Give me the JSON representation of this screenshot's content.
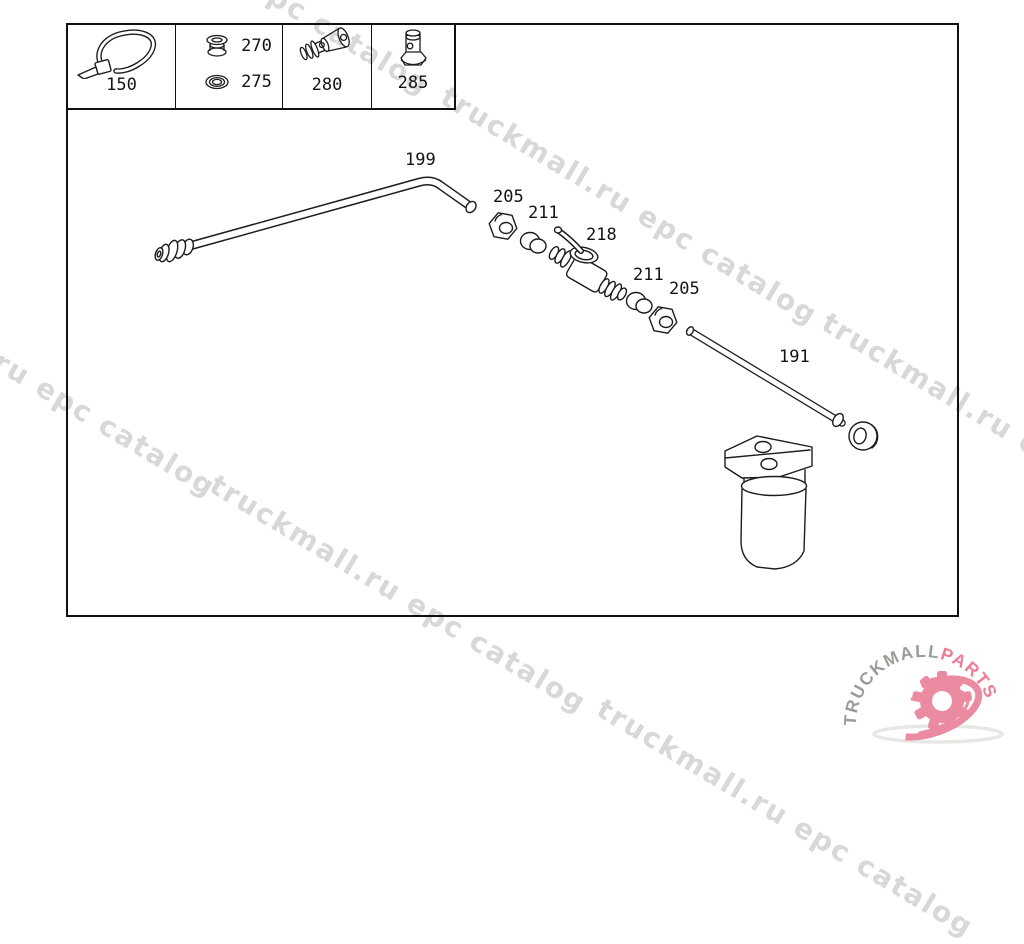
{
  "watermark": {
    "text": "truckmall.ru epc catalog",
    "color": "#d8d8d8"
  },
  "legend": {
    "cells": [
      {
        "part": "150",
        "icon": "cable-tie-icon"
      },
      {
        "parts": [
          {
            "part": "270",
            "icon": "grommet-icon"
          },
          {
            "part": "275",
            "icon": "washer-icon"
          }
        ]
      },
      {
        "part": "280",
        "icon": "hose-connector-icon"
      },
      {
        "part": "285",
        "icon": "overflow-valve-icon"
      }
    ]
  },
  "diagram": {
    "callouts": [
      {
        "part": "199"
      },
      {
        "part": "205"
      },
      {
        "part": "211"
      },
      {
        "part": "218"
      },
      {
        "part": "211"
      },
      {
        "part": "205"
      },
      {
        "part": "191"
      }
    ]
  },
  "logo": {
    "brand": "TRUCKMALL",
    "suffix": "PARTS",
    "brand_color": "#9c9c98",
    "suffix_color": "#ef7b95",
    "gear_color": "#eb8ba1",
    "shadow_color": "#d4d4cc"
  }
}
